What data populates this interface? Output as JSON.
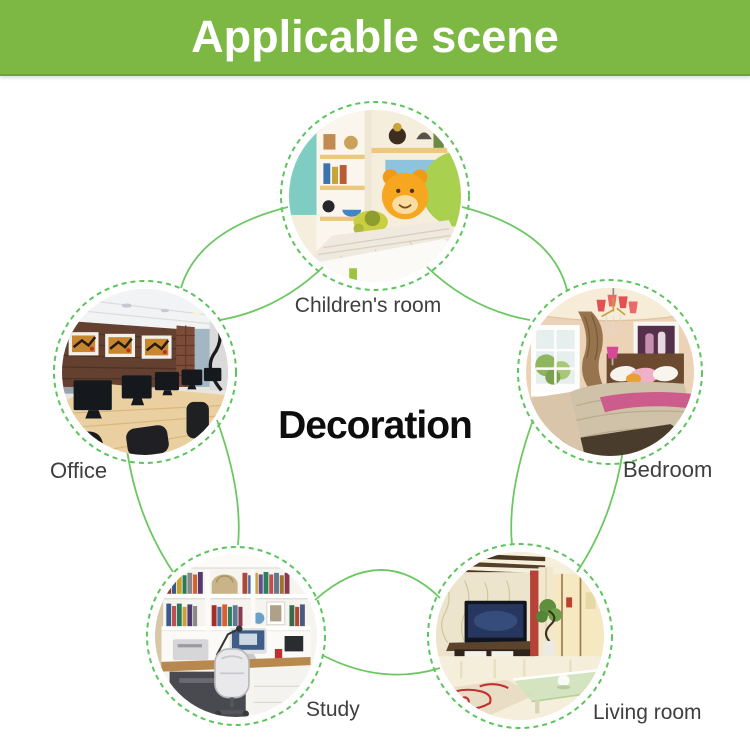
{
  "banner": {
    "title": "Applicable scene"
  },
  "center_title": "Decoration",
  "colors": {
    "banner_green": "#7cb843",
    "connector_green": "#6cc763",
    "dashed_ring_green": "#5dc45d",
    "label_gray": "#3e3e3e",
    "center_title_black": "#0d0d0d"
  },
  "nodes": [
    {
      "id": "children-room",
      "label": "Children's room"
    },
    {
      "id": "bedroom",
      "label": "Bedroom"
    },
    {
      "id": "living-room",
      "label": "Living room"
    },
    {
      "id": "study",
      "label": "Study"
    },
    {
      "id": "office",
      "label": "Office"
    }
  ]
}
